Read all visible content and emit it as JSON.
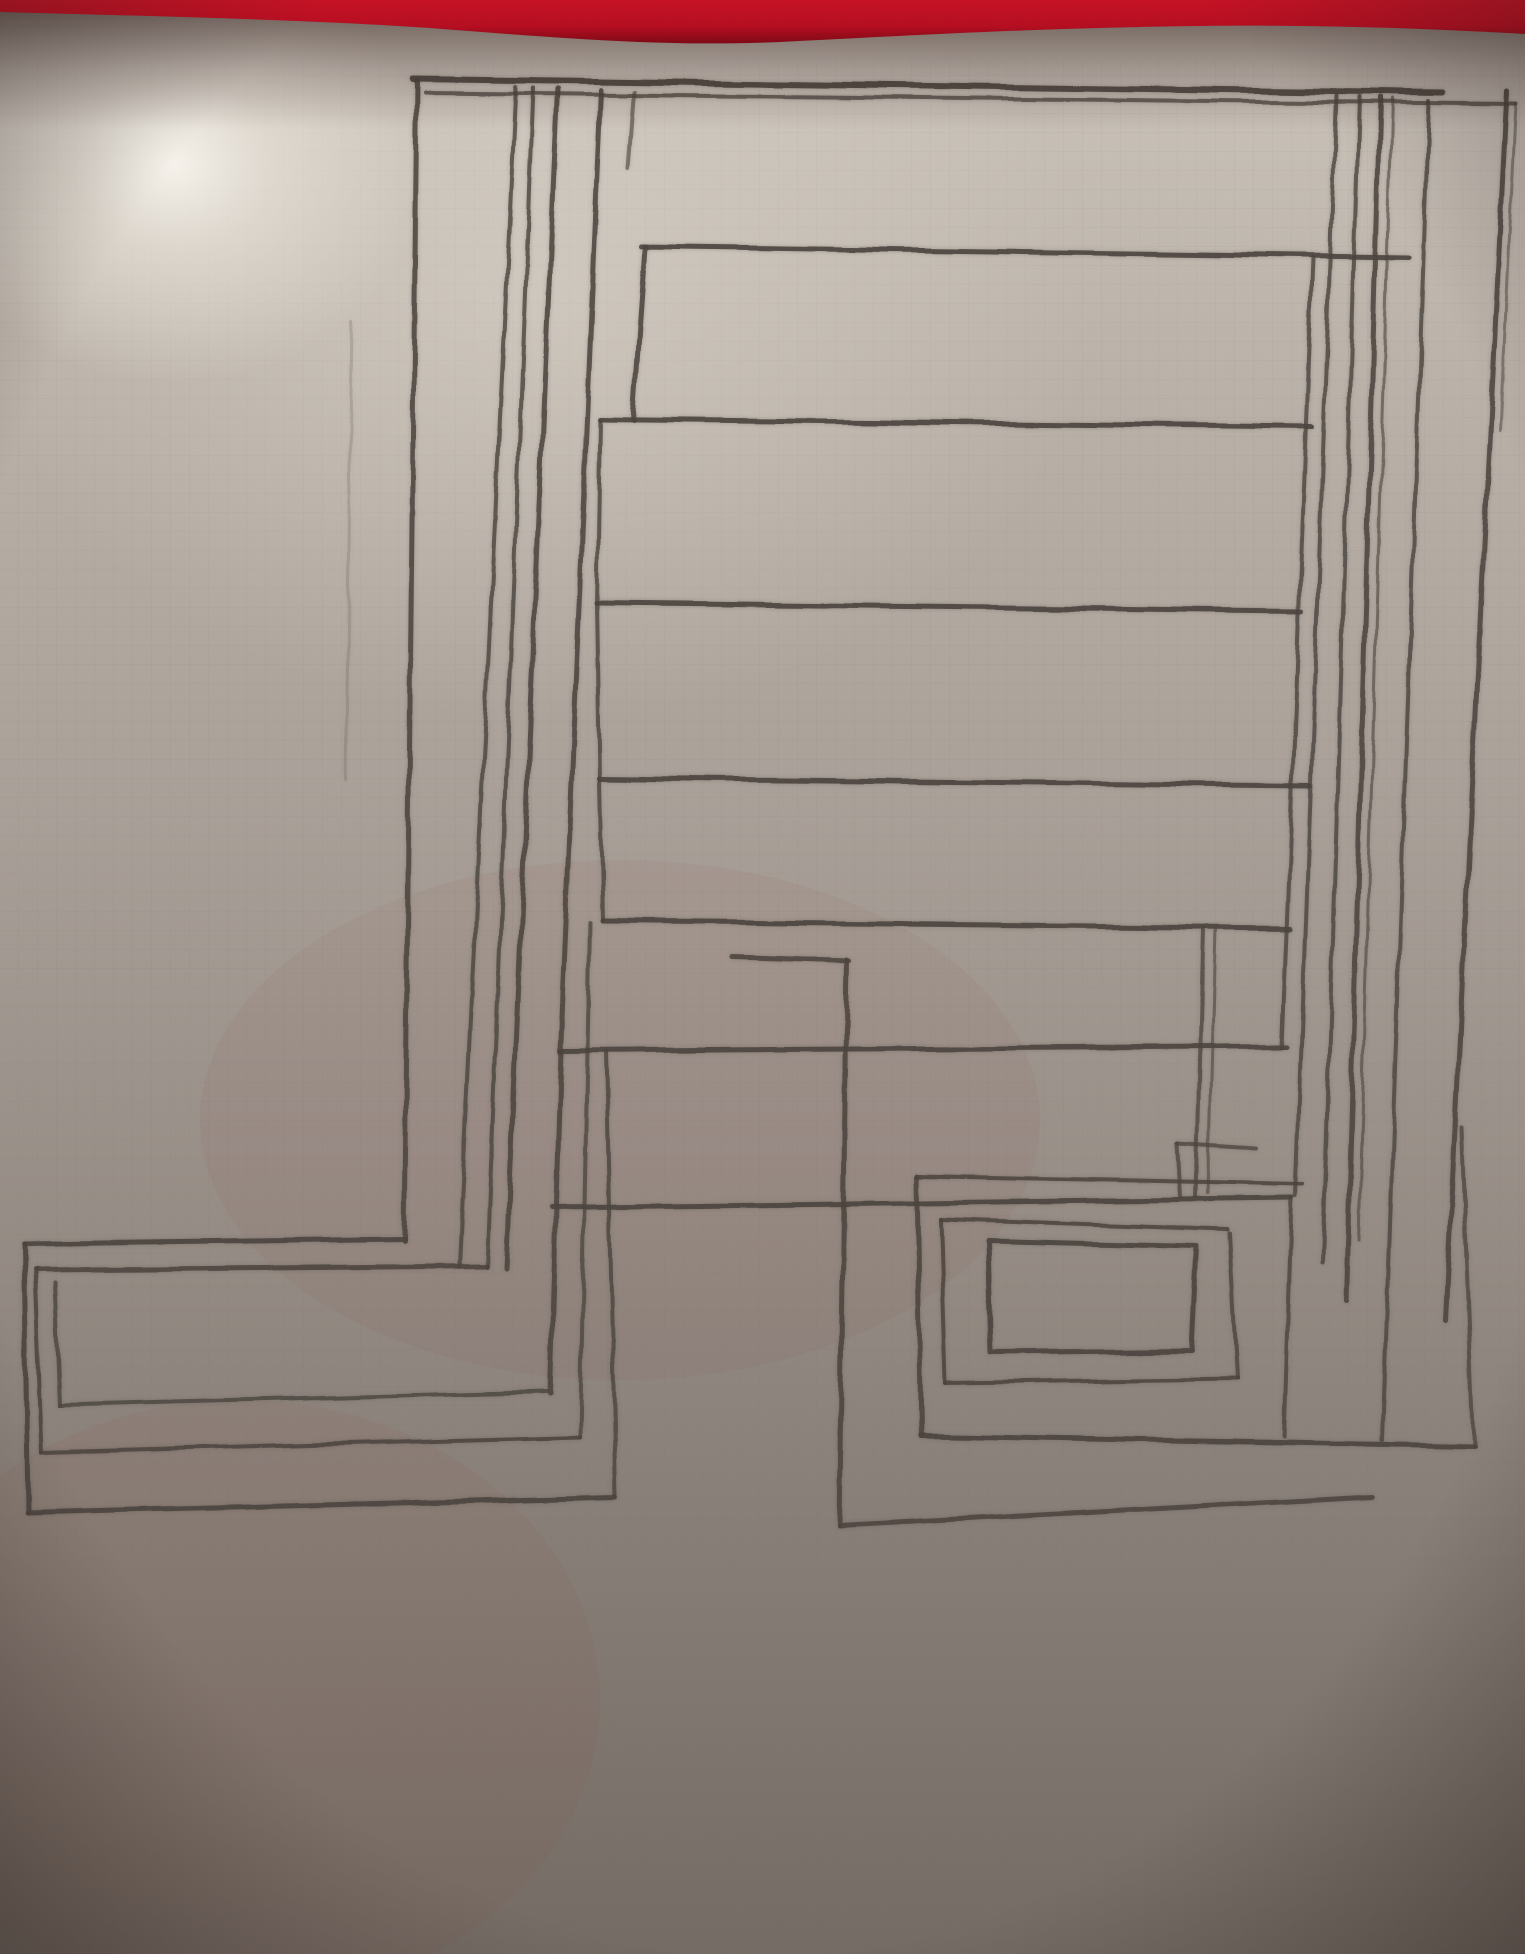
{
  "scene": {
    "width": 1525,
    "height": 1954,
    "kind": "photograph of hand-drawn pencil diagram on gray paper with red felt strip at top"
  },
  "palette": {
    "red_strip": "#b60d20",
    "red_strip_dark": "#7e0814",
    "shadow_under_strip": "#2e1a16",
    "paper_top": "#cdc6bd",
    "paper_upper": "#bcb4ab",
    "paper_mid": "#a69d95",
    "paper_lower": "#8a817a",
    "paper_bottom": "#746b64",
    "highlight_core": "#fcf9f2",
    "pencil": "#4b433d",
    "vignette": "#1e1512",
    "warm_tint": "#8a4a40"
  },
  "red_strip_path": "M0,0 L1525,0 L1525,34 C1380,26 1280,24 1140,27 C1000,30 900,36 780,42 C660,47 560,38 430,28 C300,19 140,16 0,12 Z",
  "drawing": {
    "stroke_color": "#4b433d",
    "lines": [
      {
        "n": "top-bar-upper",
        "w": 6,
        "o": 0.9,
        "p": [
          [
            413,
            79
          ],
          [
            1443,
            93
          ]
        ]
      },
      {
        "n": "top-bar-lower",
        "w": 4,
        "o": 0.75,
        "p": [
          [
            425,
            93
          ],
          [
            1516,
            104
          ]
        ]
      },
      {
        "n": "left-long-vertical",
        "w": 5,
        "o": 0.85,
        "p": [
          [
            417,
            81
          ],
          [
            404,
            1241
          ]
        ]
      },
      {
        "n": "cluster-line-1",
        "w": 4,
        "o": 0.8,
        "p": [
          [
            516,
            87
          ],
          [
            459,
            1266
          ]
        ]
      },
      {
        "n": "cluster-line-2",
        "w": 4,
        "o": 0.8,
        "p": [
          [
            533,
            88
          ],
          [
            487,
            1267
          ]
        ]
      },
      {
        "n": "cluster-line-3",
        "w": 5,
        "o": 0.85,
        "p": [
          [
            557,
            89
          ],
          [
            506,
            1268
          ]
        ]
      },
      {
        "n": "ladder-left-rail",
        "w": 5,
        "o": 0.85,
        "p": [
          [
            601,
            90
          ],
          [
            560,
            1052
          ]
        ]
      },
      {
        "n": "rail-stub",
        "w": 4,
        "o": 0.6,
        "p": [
          [
            635,
            92
          ],
          [
            629,
            168
          ]
        ]
      },
      {
        "n": "rung-1",
        "w": 5,
        "o": 0.9,
        "p": [
          [
            641,
            246
          ],
          [
            1409,
            257
          ]
        ]
      },
      {
        "n": "rung-1-left-drop",
        "w": 5,
        "o": 0.85,
        "p": [
          [
            645,
            246
          ],
          [
            633,
            420
          ]
        ]
      },
      {
        "n": "rung-2",
        "w": 5,
        "o": 0.9,
        "p": [
          [
            600,
            419
          ],
          [
            1312,
            427
          ]
        ]
      },
      {
        "n": "rung-2-left-drop",
        "w": 4,
        "o": 0.8,
        "p": [
          [
            600,
            420
          ],
          [
            597,
            604
          ]
        ]
      },
      {
        "n": "rung-3",
        "w": 5,
        "o": 0.9,
        "p": [
          [
            597,
            603
          ],
          [
            1302,
            611
          ]
        ]
      },
      {
        "n": "rung-3-left-drop",
        "w": 4,
        "o": 0.8,
        "p": [
          [
            597,
            604
          ],
          [
            600,
            779
          ]
        ]
      },
      {
        "n": "rung-4",
        "w": 5,
        "o": 0.9,
        "p": [
          [
            600,
            778
          ],
          [
            1310,
            786
          ]
        ]
      },
      {
        "n": "rung-4-left-drop",
        "w": 4,
        "o": 0.8,
        "p": [
          [
            600,
            779
          ],
          [
            603,
            921
          ]
        ]
      },
      {
        "n": "rung-5",
        "w": 5,
        "o": 0.9,
        "p": [
          [
            603,
            921
          ],
          [
            1290,
            928
          ]
        ]
      },
      {
        "n": "rung-6",
        "w": 5,
        "o": 0.9,
        "p": [
          [
            561,
            1051
          ],
          [
            1287,
            1046
          ]
        ]
      },
      {
        "n": "rung-6-left-drop",
        "w": 5,
        "o": 0.85,
        "p": [
          [
            561,
            1051
          ],
          [
            551,
            1394
          ]
        ]
      },
      {
        "n": "right-rail",
        "w": 4,
        "o": 0.8,
        "p": [
          [
            1313,
            258
          ],
          [
            1282,
            1046
          ]
        ]
      },
      {
        "n": "mid-long-horizontal",
        "w": 5,
        "o": 0.9,
        "p": [
          [
            552,
            1208
          ],
          [
            1292,
            1198
          ]
        ]
      },
      {
        "n": "mid-long-right-drop",
        "w": 4,
        "o": 0.8,
        "p": [
          [
            1292,
            1198
          ],
          [
            1284,
            1437
          ]
        ]
      },
      {
        "n": "pair-line-a",
        "w": 4,
        "o": 0.75,
        "p": [
          [
            1203,
            929
          ],
          [
            1196,
            1196
          ]
        ]
      },
      {
        "n": "pair-line-b",
        "w": 3,
        "o": 0.6,
        "p": [
          [
            1215,
            929
          ],
          [
            1208,
            1193
          ]
        ]
      },
      {
        "n": "hook-horizontal",
        "w": 4,
        "o": 0.75,
        "p": [
          [
            1178,
            1143
          ],
          [
            1257,
            1148
          ]
        ]
      },
      {
        "n": "hook-vertical",
        "w": 4,
        "o": 0.75,
        "p": [
          [
            1178,
            1143
          ],
          [
            1181,
            1197
          ]
        ]
      },
      {
        "n": "bottomleft-outer-top",
        "w": 5,
        "o": 0.9,
        "p": [
          [
            404,
            1239
          ],
          [
            24,
            1244
          ]
        ]
      },
      {
        "n": "bottomleft-outer-left",
        "w": 5,
        "o": 0.9,
        "p": [
          [
            24,
            1244
          ],
          [
            28,
            1513
          ]
        ]
      },
      {
        "n": "bottomleft-outer-bottom",
        "w": 5,
        "o": 0.9,
        "p": [
          [
            28,
            1513
          ],
          [
            616,
            1497
          ]
        ]
      },
      {
        "n": "bottomleft-outer-right",
        "w": 4,
        "o": 0.8,
        "p": [
          [
            616,
            1497
          ],
          [
            606,
            1052
          ]
        ]
      },
      {
        "n": "bottomleft-mid-top",
        "w": 5,
        "o": 0.85,
        "p": [
          [
            487,
            1266
          ],
          [
            35,
            1270
          ]
        ]
      },
      {
        "n": "bottomleft-mid-left",
        "w": 4,
        "o": 0.85,
        "p": [
          [
            35,
            1270
          ],
          [
            42,
            1452
          ]
        ]
      },
      {
        "n": "bottomleft-mid-bottom",
        "w": 4,
        "o": 0.85,
        "p": [
          [
            42,
            1452
          ],
          [
            580,
            1437
          ]
        ]
      },
      {
        "n": "bottomleft-mid-right",
        "w": 4,
        "o": 0.75,
        "p": [
          [
            580,
            1437
          ],
          [
            590,
            923
          ]
        ]
      },
      {
        "n": "bottomleft-inner-left",
        "w": 4,
        "o": 0.8,
        "p": [
          [
            55,
            1283
          ],
          [
            60,
            1405
          ]
        ]
      },
      {
        "n": "bottomleft-inner-bottom",
        "w": 4,
        "o": 0.8,
        "p": [
          [
            60,
            1405
          ],
          [
            548,
            1392
          ]
        ]
      },
      {
        "n": "bottomright-top-bar",
        "w": 5,
        "o": 0.85,
        "p": [
          [
            733,
            957
          ],
          [
            849,
            961
          ]
        ]
      },
      {
        "n": "bottomright-outer-left",
        "w": 5,
        "o": 0.85,
        "p": [
          [
            847,
            960
          ],
          [
            839,
            1526
          ]
        ]
      },
      {
        "n": "bottomright-outer-bottom",
        "w": 5,
        "o": 0.85,
        "p": [
          [
            839,
            1526
          ],
          [
            1372,
            1497
          ]
        ]
      },
      {
        "n": "bottomright-rect-a-top",
        "w": 4,
        "o": 0.85,
        "p": [
          [
            917,
            1176
          ],
          [
            1303,
            1184
          ]
        ]
      },
      {
        "n": "bottomright-rect-a-left",
        "w": 5,
        "o": 0.85,
        "p": [
          [
            917,
            1176
          ],
          [
            921,
            1436
          ]
        ]
      },
      {
        "n": "bottomright-rect-a-bottom",
        "w": 5,
        "o": 0.9,
        "p": [
          [
            921,
            1436
          ],
          [
            1474,
            1446
          ]
        ]
      },
      {
        "n": "bottomright-rect-a-right",
        "w": 4,
        "o": 0.75,
        "p": [
          [
            1474,
            1446
          ],
          [
            1462,
            1128
          ]
        ]
      },
      {
        "n": "bottomright-rect-b-top",
        "w": 4,
        "o": 0.85,
        "p": [
          [
            941,
            1219
          ],
          [
            1227,
            1229
          ]
        ]
      },
      {
        "n": "bottomright-rect-b-left",
        "w": 4,
        "o": 0.85,
        "p": [
          [
            941,
            1219
          ],
          [
            946,
            1383
          ]
        ]
      },
      {
        "n": "bottomright-rect-b-bottom",
        "w": 4,
        "o": 0.85,
        "p": [
          [
            946,
            1383
          ],
          [
            1237,
            1379
          ]
        ]
      },
      {
        "n": "bottomright-rect-b-right",
        "w": 4,
        "o": 0.8,
        "p": [
          [
            1237,
            1379
          ],
          [
            1229,
            1233
          ]
        ]
      },
      {
        "n": "bottomright-rect-c",
        "w": 5,
        "o": 0.9,
        "p": [
          [
            988,
            1241
          ],
          [
            1196,
            1246
          ],
          [
            1191,
            1351
          ],
          [
            991,
            1353
          ],
          [
            988,
            1241
          ]
        ]
      },
      {
        "n": "column-a",
        "w": 4,
        "o": 0.8,
        "p": [
          [
            1336,
            96
          ],
          [
            1296,
            1196
          ]
        ]
      },
      {
        "n": "column-b",
        "w": 4,
        "o": 0.8,
        "p": [
          [
            1359,
            97
          ],
          [
            1323,
            1262
          ]
        ]
      },
      {
        "n": "column-c",
        "w": 5,
        "o": 0.85,
        "p": [
          [
            1380,
            98
          ],
          [
            1346,
            1300
          ]
        ]
      },
      {
        "n": "column-c-double",
        "w": 3,
        "o": 0.6,
        "p": [
          [
            1392,
            99
          ],
          [
            1358,
            1240
          ]
        ]
      },
      {
        "n": "column-d",
        "w": 4,
        "o": 0.8,
        "p": [
          [
            1429,
            101
          ],
          [
            1382,
            1440
          ]
        ]
      },
      {
        "n": "column-e",
        "w": 5,
        "o": 0.85,
        "p": [
          [
            1507,
            91
          ],
          [
            1446,
            1320
          ]
        ]
      },
      {
        "n": "column-e-stub",
        "w": 3,
        "o": 0.5,
        "p": [
          [
            1516,
            104
          ],
          [
            1500,
            430
          ]
        ]
      },
      {
        "n": "faint-graphite-vertical",
        "w": 3,
        "o": 0.18,
        "p": [
          [
            352,
            320
          ],
          [
            346,
            780
          ]
        ]
      }
    ]
  }
}
